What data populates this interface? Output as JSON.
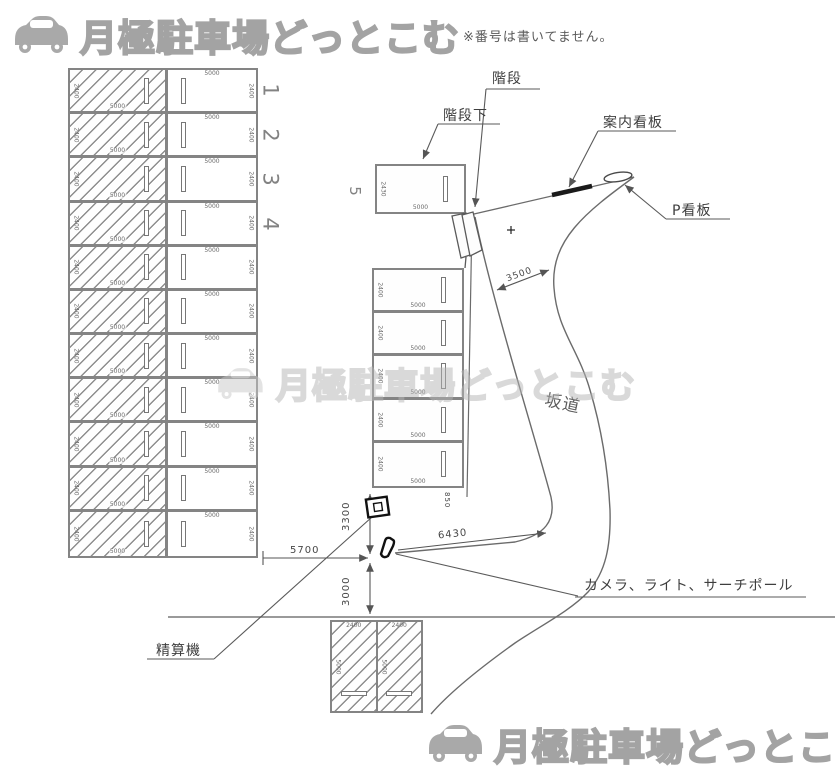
{
  "branding": {
    "logo_text": "月極駐車場どっとこむ"
  },
  "note": "※番号は書いてません。",
  "watermark": "月極駐車場どっとこむ",
  "callouts": {
    "under_stairs": "階段下",
    "stairs": "階段",
    "guide_sign": "案内看板",
    "p_sign": "P看板",
    "slope": "坂道",
    "camera_light_pole": "カメラ、ライト、サーチポール",
    "pay_machine": "精算機"
  },
  "dimensions": {
    "street_front": "5700",
    "setback_upper": "3300",
    "setback_lower": "3000",
    "entrance_span": "6430",
    "road_width": "3500",
    "side_gap": "850"
  },
  "left_block": {
    "row_count": 11,
    "numbered_rows": [
      "1",
      "2",
      "3",
      "4"
    ],
    "cell_width": "5000",
    "cell_depth": "2400"
  },
  "top_block": {
    "number": "5",
    "depth": "2430",
    "width": "5000"
  },
  "mid_block": {
    "row_count": 5,
    "cell_width": "5000",
    "cell_depth": "2400"
  },
  "bottom_block": {
    "cell_count": 2,
    "cell_width": "2400",
    "cell_depth": "5000"
  }
}
